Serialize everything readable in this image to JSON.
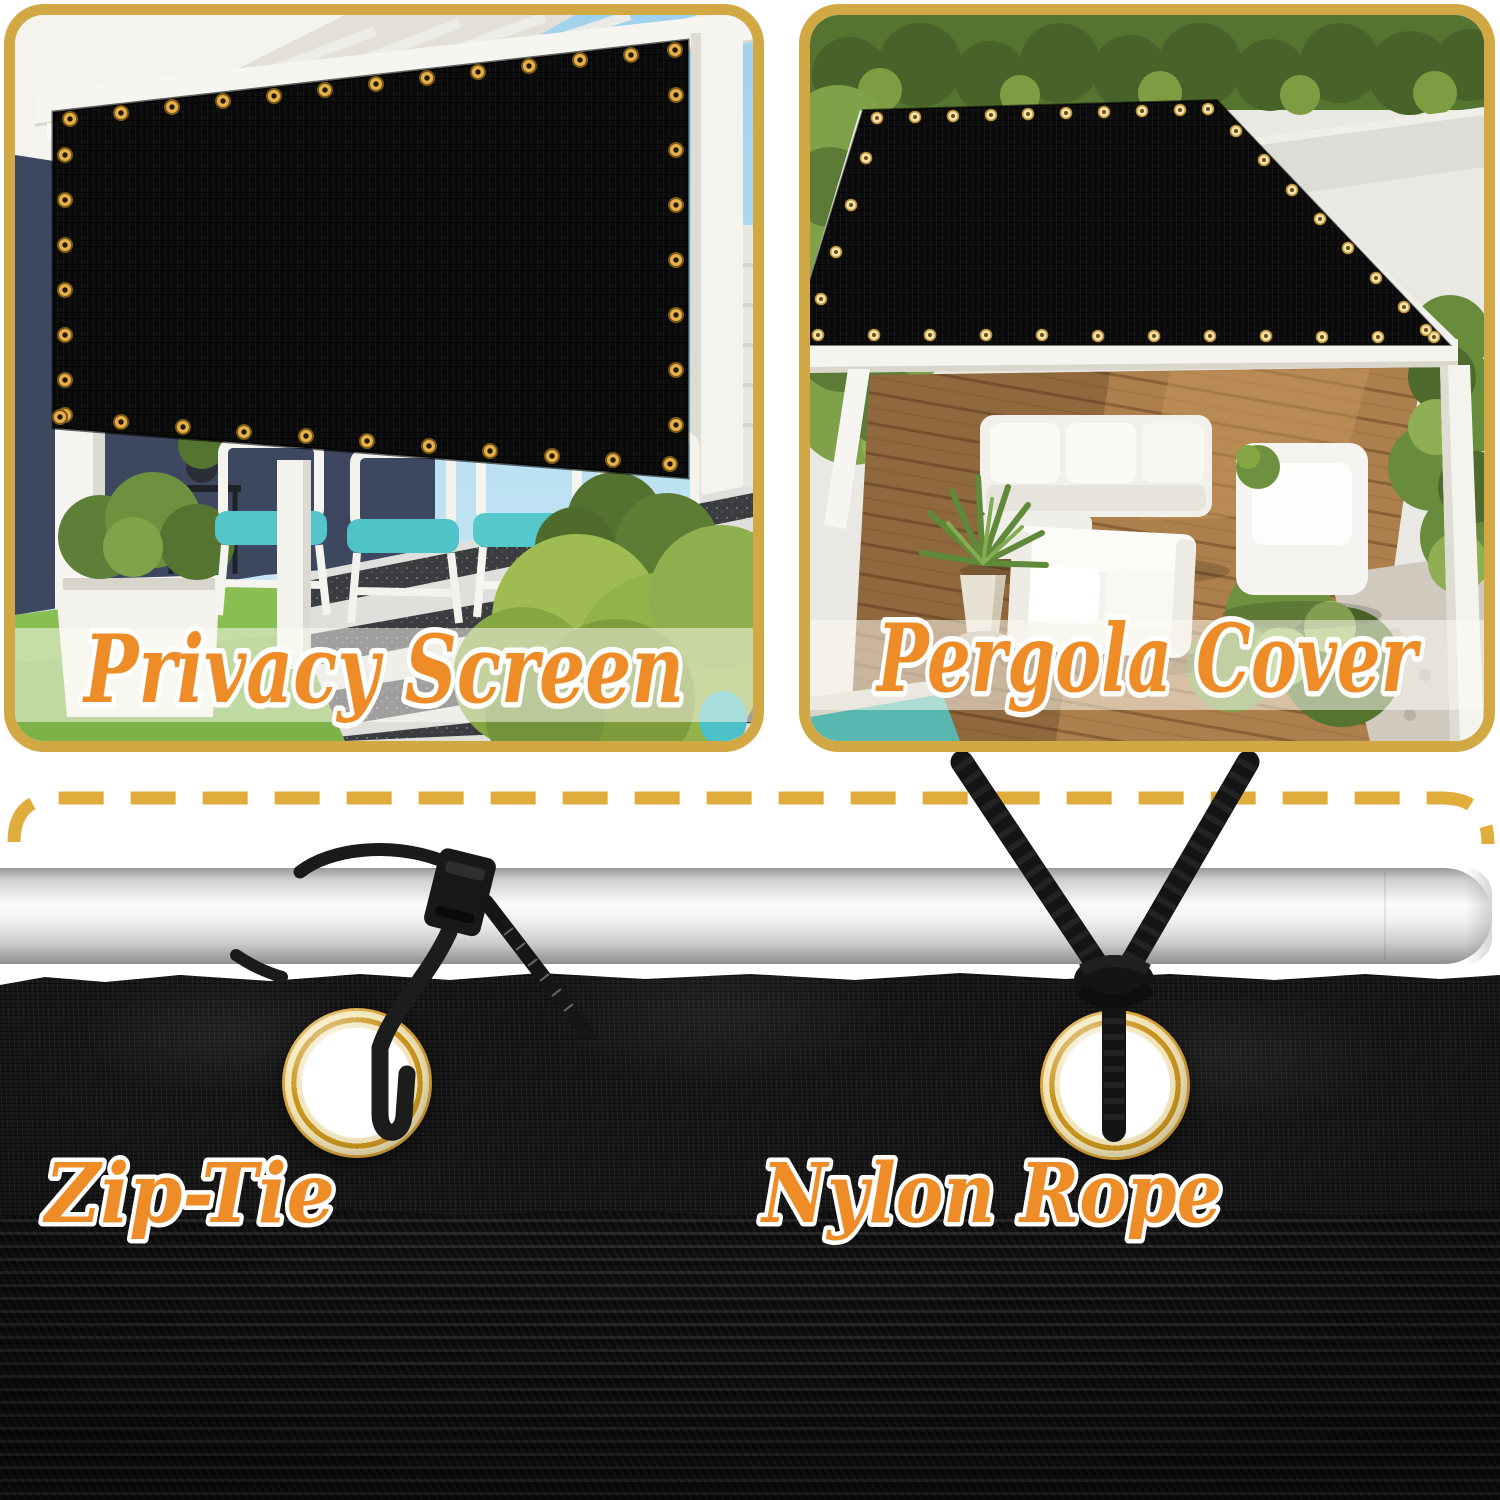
{
  "cards": {
    "privacy_screen": {
      "label": "Privacy Screen"
    },
    "pergola_cover": {
      "label": "Pergola Cover"
    }
  },
  "mounting": {
    "zip_tie": {
      "label": "Zip-Tie"
    },
    "nylon_rope": {
      "label": "Nylon Rope"
    }
  },
  "colors": {
    "background": "#ffffff",
    "card_border_gold": "#d2a845",
    "dashed_line_gold": "#e0ad3d",
    "label_fill_orange": "#ee8c28",
    "label_outline_white": "#ffffff",
    "grommet_brass": "#e2a93c",
    "shade_fabric_black": "#141414",
    "pole_silver": "#d9d9d9",
    "sky_blue": "#a9d7ee",
    "grass_green": "#7db249",
    "cushion_teal": "#52c6ca",
    "deck_wood_brown": "#ad7f4c"
  },
  "icons": {
    "grommet": "brass-grommet-ring",
    "zip_tie": "cable-zip-tie",
    "nylon_rope": "braided-nylon-rope",
    "mounting_pole": "metal-mounting-pole",
    "dashed_frame": "gold-dashed-border"
  }
}
